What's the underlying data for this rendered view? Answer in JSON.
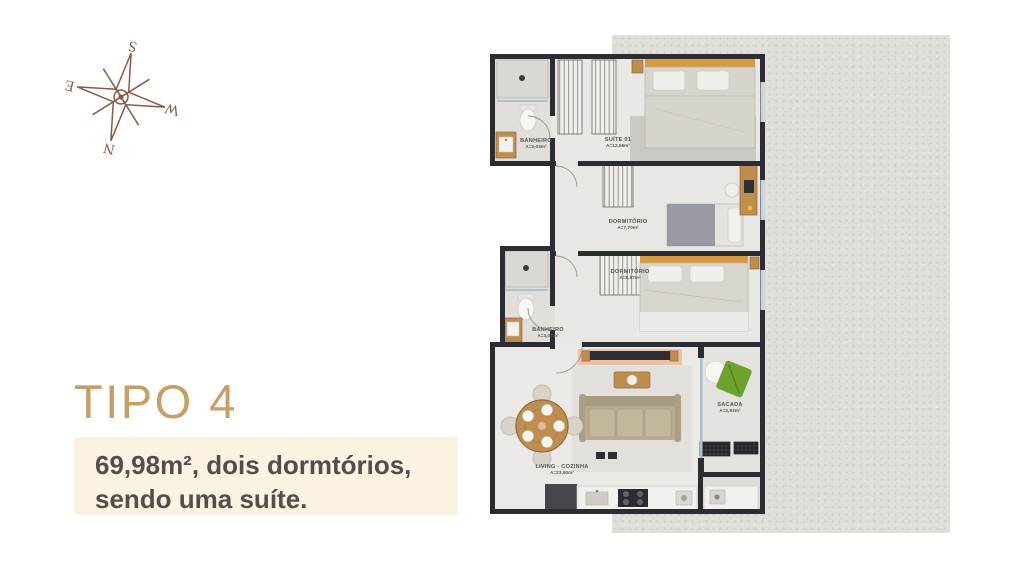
{
  "window": {
    "background": "#ffffff"
  },
  "texture_panel": {
    "background": "#e0ded9"
  },
  "compass": {
    "color": "#8a5a44",
    "n": "N",
    "s": "S",
    "e": "E",
    "w": "W"
  },
  "title": {
    "label": "TIPO 4",
    "color": "#c79e66"
  },
  "subtitle": {
    "line1": "69,98m², dois dormtórios,",
    "line2": "sendo uma suíte.",
    "background": "#faf3e2",
    "color": "#534e48"
  },
  "floorplan": {
    "wall_color": "#2c2c33",
    "floor_color": "#eae8e5",
    "accent_wood": "#bd8e4e",
    "accent_orange": "#d69a40",
    "accent_green": "#6ba32c",
    "rooms": [
      {
        "name": "BANHEIRO",
        "area": "A=2,03m²"
      },
      {
        "name": "SUÍTE 01",
        "area": "A=12,56m²"
      },
      {
        "name": "DORMITÓRIO",
        "area": "A=7,70m²"
      },
      {
        "name": "DORMITÓRIO",
        "area": "A=8,97m²"
      },
      {
        "name": "BANHEIRO",
        "area": "A=3,01m²"
      },
      {
        "name": "SACADA",
        "area": "A=2,92m²"
      },
      {
        "name": "LIVING - COZINHA",
        "area": "A=23,90m²"
      }
    ]
  }
}
